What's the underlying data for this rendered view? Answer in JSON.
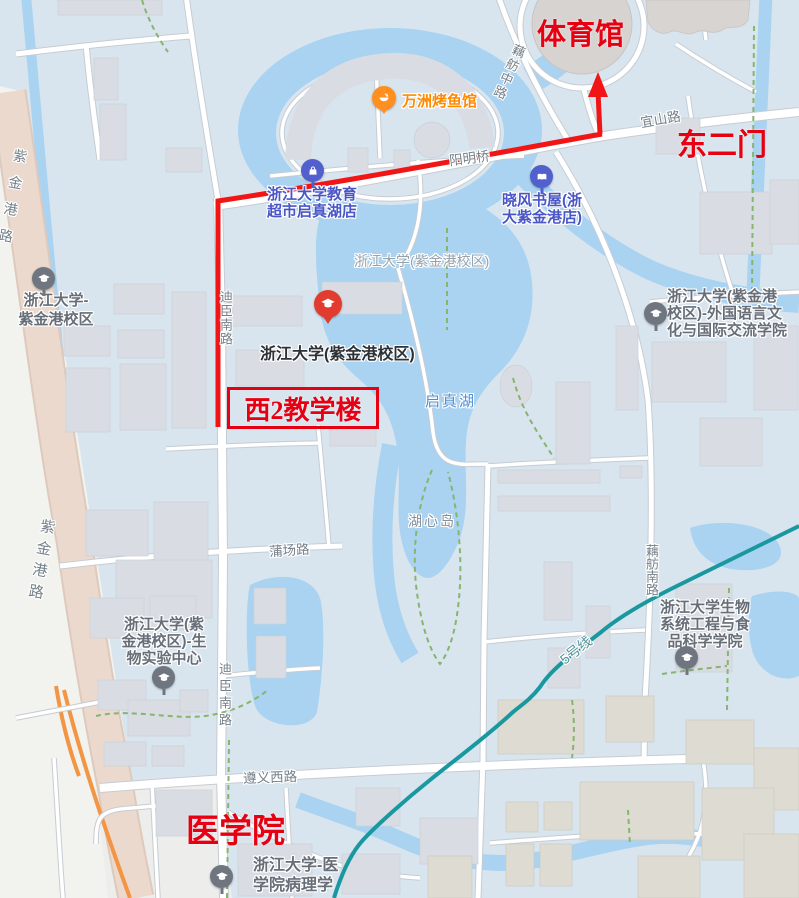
{
  "red_annotations": {
    "gym": "体育馆",
    "east_gate": "东二门",
    "teaching_building": "西2教学楼",
    "medical_school": "医学院"
  },
  "pois": {
    "grill_restaurant": {
      "label": "万洲烤鱼馆",
      "icon": "restaurant-bowl-icon",
      "color": "#ff8a00"
    },
    "edu_supermarket": {
      "line1": "浙江大学教育",
      "line2": "超市启真湖店",
      "icon": "shopping-bag-icon",
      "color": "#4a56c6"
    },
    "bookstore": {
      "line1": "晓风书屋(浙",
      "line2": "大紫金港店)",
      "icon": "book-icon",
      "color": "#4a56c6"
    },
    "zju_main": {
      "label": "浙江大学(紫金港校区)",
      "icon": "graduation-cap-icon",
      "color": "#e23c30"
    },
    "zju_campus_west": {
      "line1": "浙江大学-",
      "line2": "紫金港校区",
      "icon": "graduation-cap-icon",
      "color": "#6f7680"
    },
    "foreign_language_school": {
      "line1": "浙江大学(紫金港",
      "line2": "校区)-外国语言文",
      "line3": "化与国际交流学院",
      "icon": "graduation-cap-icon",
      "color": "#6f7680"
    },
    "bio_lab_center": {
      "line1": "浙江大学(紫",
      "line2": "金港校区)-生",
      "line3": "物实验中心",
      "icon": "graduation-cap-icon",
      "color": "#6f7680"
    },
    "bio_food_school": {
      "line1": "浙江大学生物",
      "line2": "系统工程与食",
      "line3": "品科学学院",
      "icon": "graduation-cap-icon",
      "color": "#6f7680"
    },
    "pathology_dept": {
      "line1": "浙江大学-医",
      "line2": "学院病理学",
      "icon": "graduation-cap-icon",
      "color": "#6f7680"
    }
  },
  "road_labels": {
    "zijingang_road_north": "紫金港路",
    "zijingang_road_south": "紫金港路",
    "dichen_south_road_north": "迪臣南路",
    "dichen_south_road_south": "迪臣南路",
    "oufang_middle_road": "藕舫中路",
    "oufang_south_road": "藕舫南路",
    "yishan_road": "宜山路",
    "yangming_bridge": "阳明桥",
    "puchang_road": "蒲场路",
    "zunyi_west_road": "遵义西路",
    "metro_line_5": "5号线"
  },
  "area_labels": {
    "campus": "浙江大学(紫金港校区)",
    "qizhen_lake": "启真湖",
    "lake_island": "湖心岛"
  },
  "colors": {
    "route_red": "#f21515",
    "annotation_red": "#e60012",
    "water_blue": "#a9d3f1",
    "campus_bg": "#d9e5ee",
    "metro_teal": "#1a98a0",
    "highway_tan": "#ecd9ce",
    "ramp_orange": "#f29544",
    "poi_blue": "#4a56c6",
    "poi_orange": "#ff8a00",
    "poi_gray": "#6f7680",
    "building_gray": "#d9dde3"
  }
}
